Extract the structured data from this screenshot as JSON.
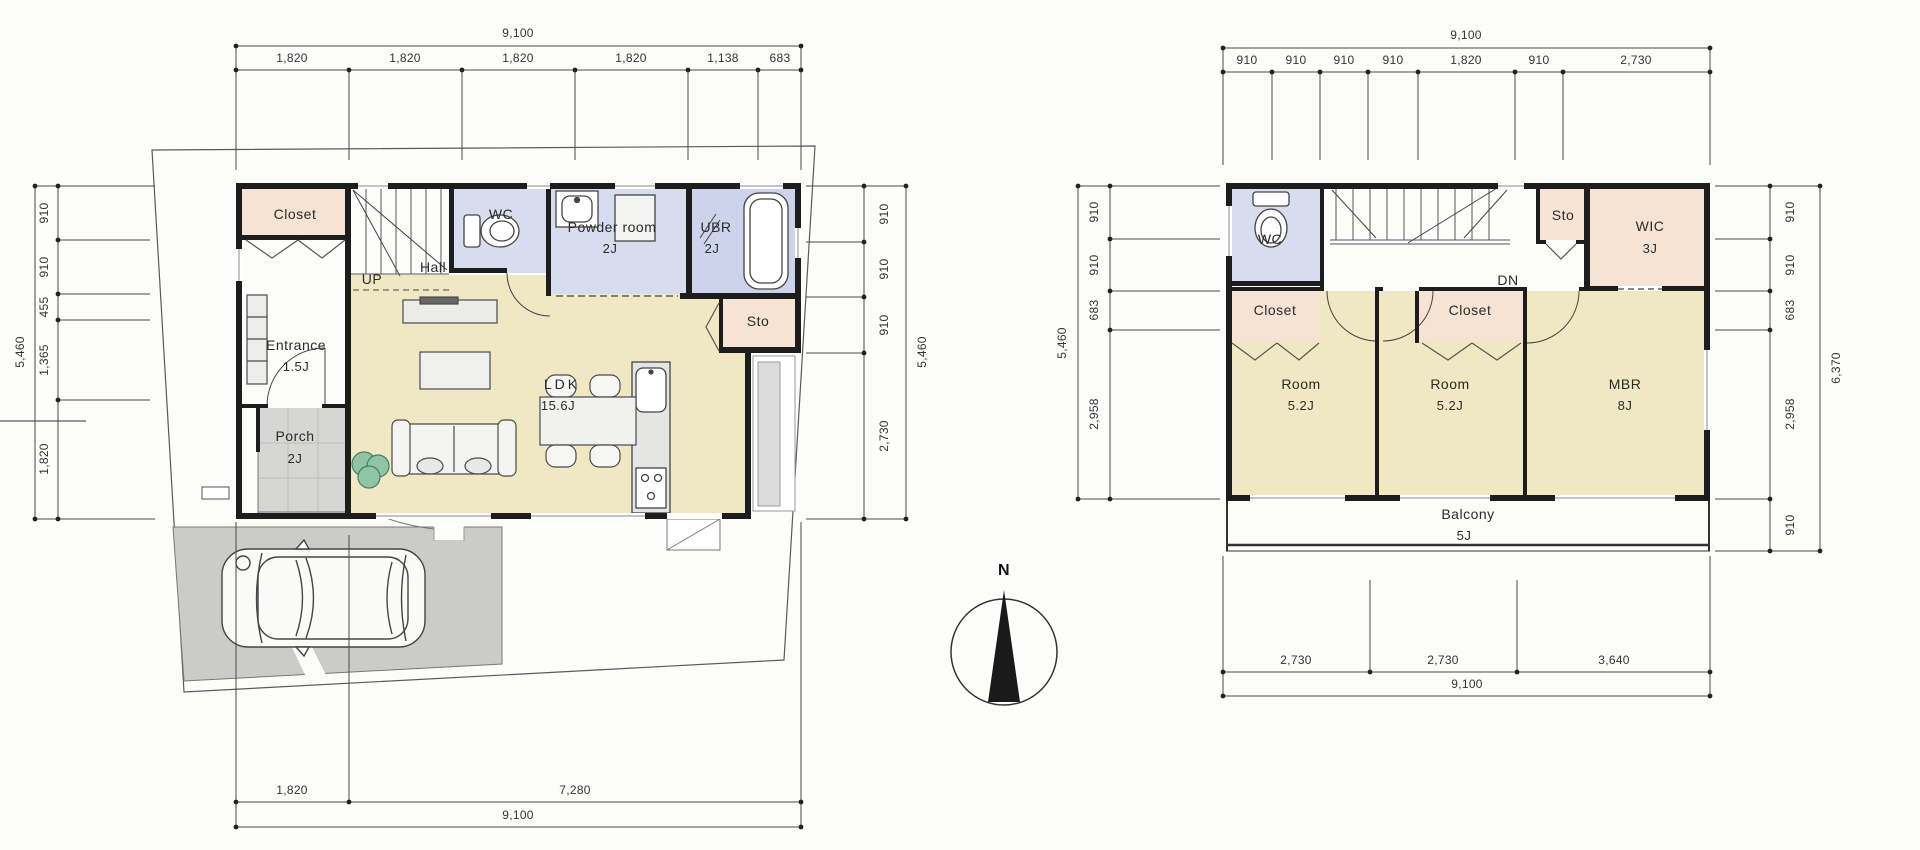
{
  "floor1": {
    "rooms": {
      "closet": "Closet",
      "hall": "Hall",
      "up": "UP",
      "wc": "WC",
      "powder_name": "Powder room",
      "powder_size": "2J",
      "ubr_name": "UBR",
      "ubr_size": "2J",
      "entrance_name": "Entrance",
      "entrance_size": "1.5J",
      "porch_name": "Porch",
      "porch_size": "2J",
      "ldk_name": "LDK",
      "ldk_size": "15.6J",
      "sto": "Sto"
    },
    "dims": {
      "top": {
        "total": "9,100",
        "segs": [
          "1,820",
          "1,820",
          "1,820",
          "1,820",
          "1,138",
          "683"
        ]
      },
      "left": {
        "total": "5,460",
        "segs": [
          "910",
          "910",
          "455",
          "1,365",
          "1,820"
        ]
      },
      "right": {
        "total": "5,460",
        "segs": [
          "910",
          "910",
          "910",
          "2,730"
        ]
      },
      "bottom": {
        "total": "9,100",
        "segs": [
          "1,820",
          "7,280"
        ]
      }
    }
  },
  "floor2": {
    "rooms": {
      "wc": "WC",
      "dn": "DN",
      "sto": "Sto",
      "wic_name": "WIC",
      "wic_size": "3J",
      "closet1": "Closet",
      "closet2": "Closet",
      "room1_name": "Room",
      "room1_size": "5.2J",
      "room2_name": "Room",
      "room2_size": "5.2J",
      "mbr_name": "MBR",
      "mbr_size": "8J",
      "balcony_name": "Balcony",
      "balcony_size": "5J"
    },
    "dims": {
      "top": {
        "total": "9,100",
        "segs": [
          "910",
          "910",
          "910",
          "910",
          "1,820",
          "910",
          "2,730"
        ]
      },
      "left": {
        "total": "5,460",
        "segs": [
          "910",
          "910",
          "683",
          "2,958"
        ]
      },
      "right": {
        "total": "6,370",
        "segs": [
          "910",
          "910",
          "683",
          "2,958",
          "910"
        ]
      },
      "bottom": {
        "total": "9,100",
        "segs": [
          "2,730",
          "2,730",
          "3,640"
        ]
      }
    }
  },
  "compass": {
    "north": "N"
  }
}
